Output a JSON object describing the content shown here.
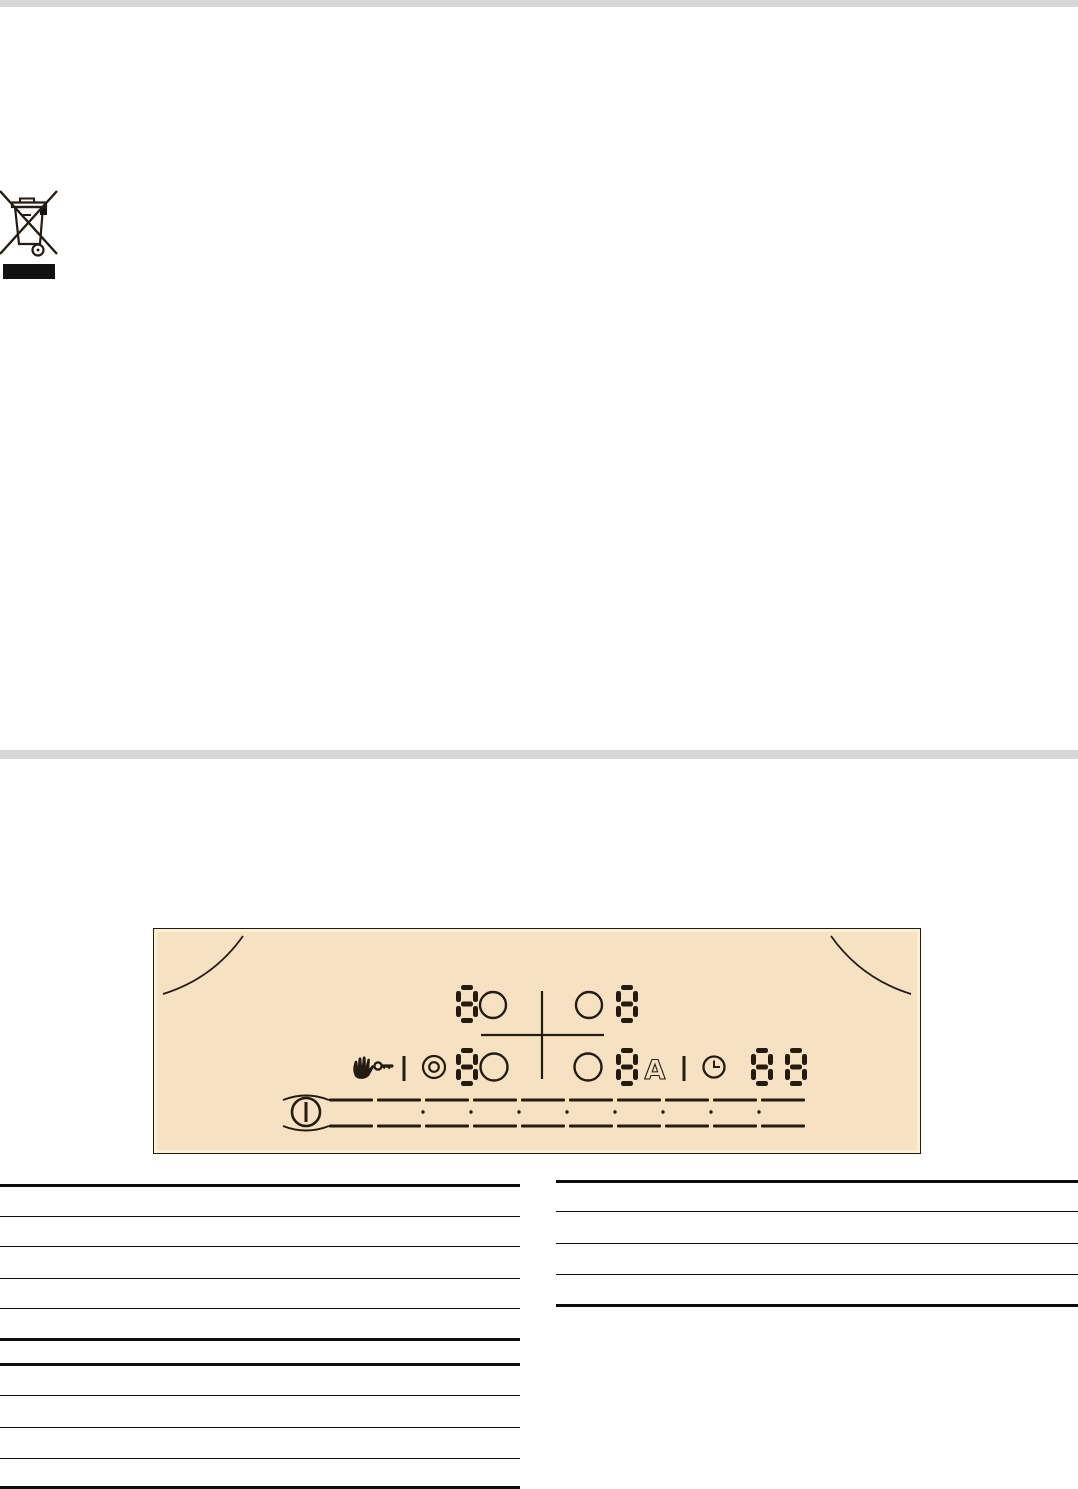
{
  "page": {
    "background_color": "#ffffff",
    "top_bar_color": "#d6d6d6",
    "top_bar_height": 7,
    "divider_bar_color": "#d6d6d6",
    "divider_bar_top": 750,
    "divider_bar_height": 9
  },
  "weee_symbol": {
    "label": "crossed-out wheeled bin disposal symbol",
    "has_solid_bar_below": true,
    "color": "#111111"
  },
  "control_panel": {
    "background_color": "#f6e2c3",
    "inner_edge_color": "#fbf0d2",
    "glyph_color": "#241b11",
    "auto_label": "A",
    "displays": {
      "front_left_zone_digit": "8",
      "front_right_zone_digit": "8",
      "rear_left_zone_digit": "8",
      "rear_right_zone_digit": "8",
      "timer_digit_1": "8",
      "timer_digit_2": "8"
    },
    "icons": [
      "hand-childlock-icon",
      "key-icon",
      "residual-heat-indicator-icon",
      "auto-heat-up-letter-a",
      "clock-timer-icon",
      "power-on-off-icon"
    ],
    "zone_indicator_circles": 4,
    "slider": {
      "segment_count": 10,
      "dot_count": 8
    }
  },
  "rule_lines": {
    "left_column": {
      "x": 0,
      "width": 520,
      "lines": [
        {
          "y": 1184,
          "weight": 2.6
        },
        {
          "y": 1216,
          "weight": 1.2
        },
        {
          "y": 1246,
          "weight": 1.2
        },
        {
          "y": 1278,
          "weight": 1.2
        },
        {
          "y": 1308,
          "weight": 1.2
        },
        {
          "y": 1338,
          "weight": 2.6
        },
        {
          "y": 1363,
          "weight": 2.6
        },
        {
          "y": 1395,
          "weight": 1.2
        },
        {
          "y": 1427,
          "weight": 1.2
        },
        {
          "y": 1458,
          "weight": 1.2
        },
        {
          "y": 1486,
          "weight": 2.8
        }
      ]
    },
    "right_column": {
      "x": 556,
      "width": 522,
      "lines": [
        {
          "y": 1180,
          "weight": 2.6
        },
        {
          "y": 1211,
          "weight": 1.2
        },
        {
          "y": 1243,
          "weight": 1.2
        },
        {
          "y": 1274,
          "weight": 1.2
        },
        {
          "y": 1304,
          "weight": 2.6
        }
      ]
    }
  }
}
